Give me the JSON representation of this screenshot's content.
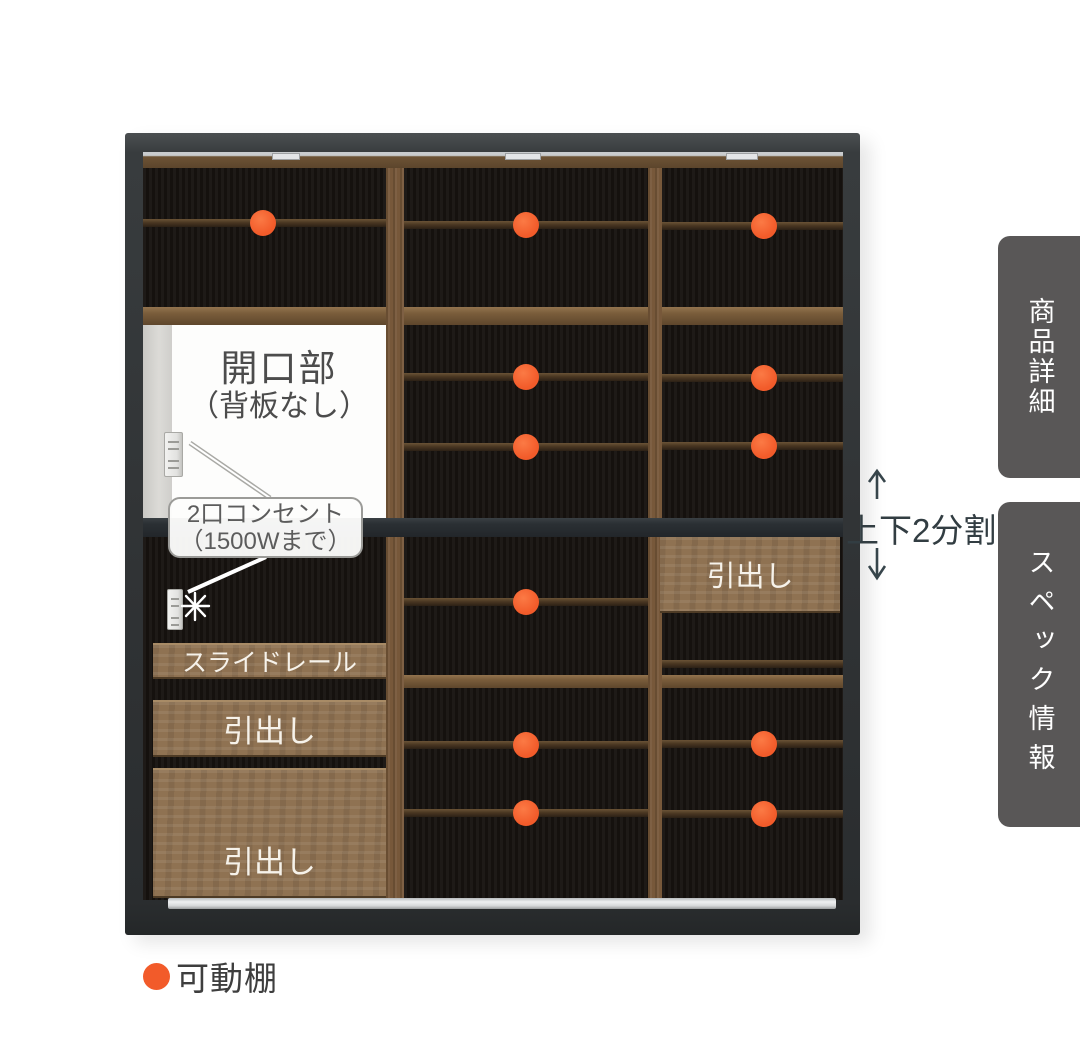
{
  "colors": {
    "accent": "#F25B2A",
    "tab_bg": "#595757",
    "frame": "#303335",
    "drawer_wood": "#8F7252",
    "annotation_text": "#4C4C4C",
    "split_text": "#323D42"
  },
  "cabinet": {
    "opening": {
      "line1": "開口部",
      "line2": "（背板なし）"
    },
    "outlet_label": {
      "line1": "2口コンセント",
      "line2": "（1500Wまで）"
    },
    "drawers": {
      "slide_rail": "スライドレール",
      "left_top": "引出し",
      "left_bottom": "引出し",
      "right": "引出し"
    },
    "shelf_markers": [
      {
        "x": 263,
        "y": 223
      },
      {
        "x": 526,
        "y": 225
      },
      {
        "x": 764,
        "y": 226
      },
      {
        "x": 526,
        "y": 377
      },
      {
        "x": 764,
        "y": 378
      },
      {
        "x": 526,
        "y": 447
      },
      {
        "x": 764,
        "y": 446
      },
      {
        "x": 526,
        "y": 602
      },
      {
        "x": 526,
        "y": 745
      },
      {
        "x": 764,
        "y": 744
      },
      {
        "x": 526,
        "y": 813
      },
      {
        "x": 764,
        "y": 814
      }
    ]
  },
  "annotations": {
    "split_label": "上下2分割",
    "icons": {
      "up_arrow": "↑",
      "down_arrow": "↓",
      "starburst": "✳",
      "shelf_dot": "●"
    }
  },
  "legend": {
    "adjustable_shelf": "可動棚"
  },
  "sidebar_tabs": [
    {
      "label": "商品詳細"
    },
    {
      "label": "スペック情報"
    }
  ]
}
